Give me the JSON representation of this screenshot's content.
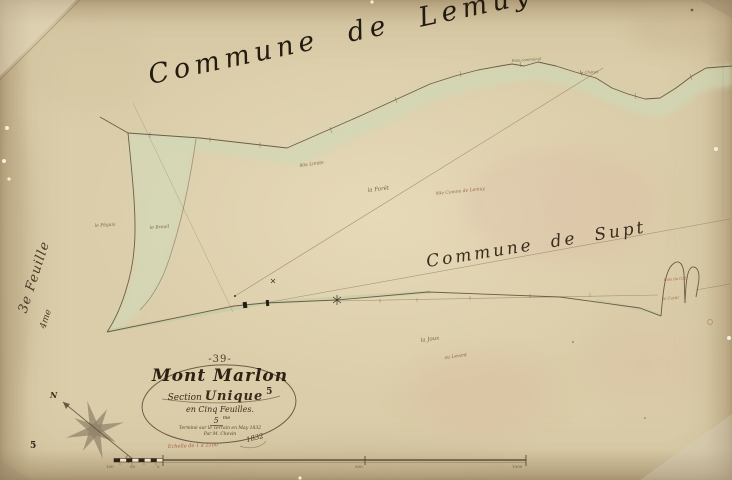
{
  "map": {
    "commune_top": "Commune de Lemuy",
    "commune_right": "Commune de Supt",
    "side_sheet_label": "3e Feuille",
    "side_sheet_number": "4me",
    "page_number": "5",
    "north_label": "N"
  },
  "cartouche": {
    "plate_number": "-39-",
    "title": "Mont Marlon",
    "section_word": "Section",
    "section_name": "Unique",
    "section_sup": "5",
    "feuilles_line": "en Cinq Feuilles.",
    "sheet_ordinal_num": "5",
    "sheet_ordinal_sup": "me",
    "survey_line1": "Terminé sur le Terrain en May 1832",
    "survey_line2": "Par M. Chevin",
    "year": "1832"
  },
  "scale_bar": {
    "label": "Echelle de 1 à 2500",
    "numbers": [
      "100",
      "50",
      "0",
      "500",
      "1000"
    ]
  },
  "annotations": [
    {
      "text": "90e Limite"
    },
    {
      "text": "la Forêt"
    },
    {
      "text": "99e Comne de Lemuy"
    },
    {
      "text": "la Joux"
    },
    {
      "text": "au Levant"
    },
    {
      "text": "le Pâquis"
    },
    {
      "text": "le Breuil"
    },
    {
      "text": "Bois communal"
    },
    {
      "text": "le Chanet"
    },
    {
      "text": "Bois du Crêt"
    },
    {
      "text": "le Curtil"
    }
  ],
  "colors": {
    "paper": "#dbcda9",
    "ink": "#4a3b28",
    "wash_green": "#ccd9b6",
    "red_ink": "#a5604a"
  }
}
